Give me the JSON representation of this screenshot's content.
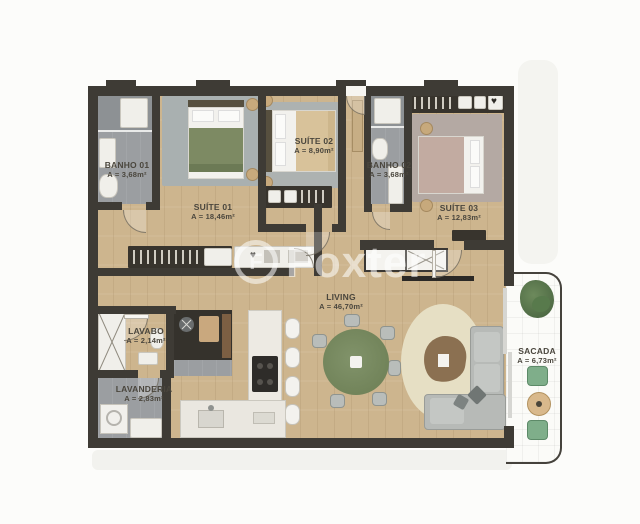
{
  "watermark": {
    "brand": "Foxter",
    "monogram": "F"
  },
  "icons": {
    "wardrobe_heart": "♥"
  },
  "rooms": {
    "banho01": {
      "name": "BANHO 01",
      "area": "A = 3,68m²"
    },
    "suite01": {
      "name": "SUÍTE 01",
      "area": "A = 18,46m²"
    },
    "suite02": {
      "name": "SUÍTE 02",
      "area": "A = 8,90m²"
    },
    "banho02": {
      "name": "BANHO 02",
      "area": "A = 3,68m²"
    },
    "suite03": {
      "name": "SUÍTE 03",
      "area": "A = 12,83m²"
    },
    "living": {
      "name": "LIVING",
      "area": "A = 46,70m²"
    },
    "lavabo": {
      "name": "LAVABO",
      "area": "A = 2,14m²"
    },
    "lavanderia": {
      "name": "LAVANDERIA",
      "area": "A = 2,83m²"
    },
    "sacada": {
      "name": "SACADA",
      "area": "A = 6,73m²"
    }
  },
  "colors": {
    "wall": "#3e3b35",
    "wood_floor": "#cdb58e",
    "tile_floor": "#9b9ea1",
    "living_rug": "#e6dfc4",
    "dining_table_green": "#76875d",
    "balcony_green": "#7fae8a",
    "bed_blanket_green": "#7d8a63",
    "bed_blanket_beige": "#d8c29a",
    "bed_blanket_rose": "#c2aba1"
  }
}
